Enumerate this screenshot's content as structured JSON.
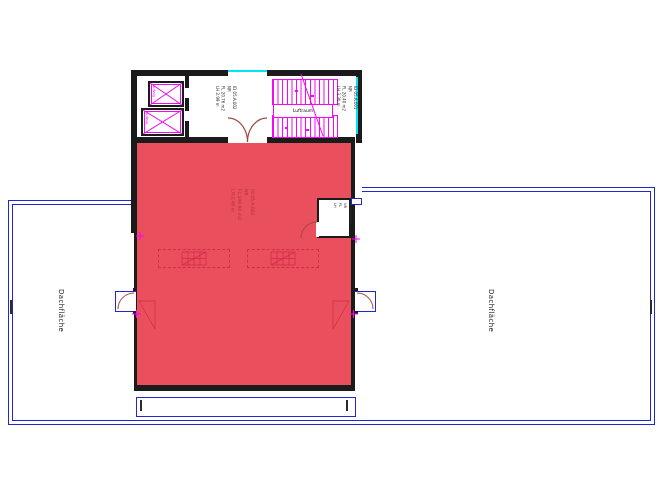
{
  "drawing": {
    "labels": {
      "left_roof": "Dachfläche",
      "right_roof": "Dachfläche",
      "stair_void": "Luftraum",
      "elevator": "Aufzug"
    },
    "stamps": {
      "corridor": {
        "l1": "ID 05.A.002",
        "l2": "NR",
        "l3": "FL 20.76 m2",
        "l4": "LH 2.99 m"
      },
      "stairwell": {
        "l1": "ID 05.A.001",
        "l2": "NR",
        "l3": "FL 20.40 m2",
        "l4": "LH 3.30 m"
      },
      "hall": {
        "l1": "ID 05.A.004",
        "l2": "NR",
        "l3": "FL 199.90 m2",
        "l4": "LH 2.40 m"
      },
      "storage": {
        "l1": "ID 05.A.003",
        "l2": "NR",
        "l3": "FL",
        "l4": "LH"
      }
    },
    "colors": {
      "roof_outline": "#2226cf",
      "hall_fill": "#e94f5c",
      "stair_magenta": "#f705f7",
      "window_cyan": "#00e4f4",
      "wall": "#1b1b1b",
      "door_arc": "#9c4b43",
      "skylight": "#d62a4a",
      "stamp_red": "#b23040"
    }
  }
}
